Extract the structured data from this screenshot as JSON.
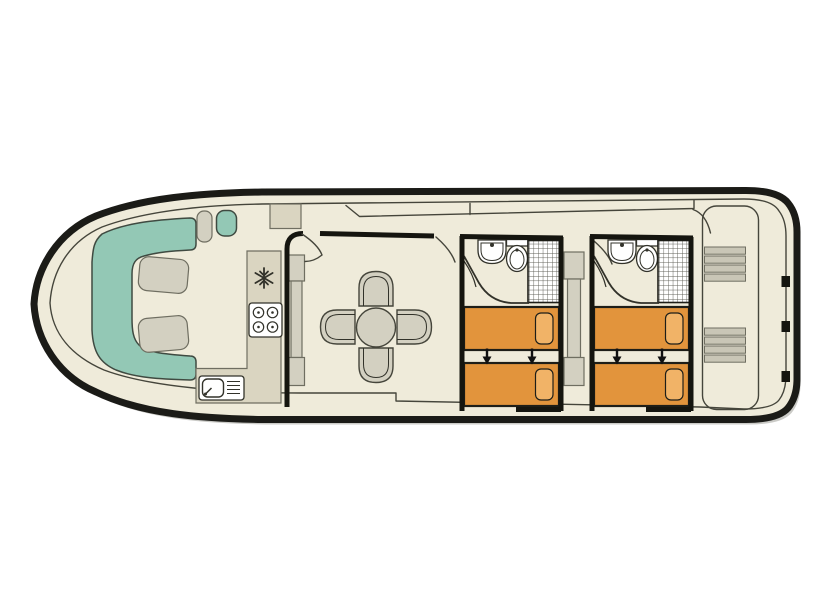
{
  "image": {
    "kind": "boat-deck-floor-plan",
    "label": "Canal boat deck plan, bow at left, stern at right"
  },
  "colors": {
    "page_bg": "#ffffff",
    "hull": "#1b1b17",
    "deck": "#EFEBDA",
    "line": "#45453b",
    "wall": "#15150f",
    "teal": "#93C8B5",
    "teal_line": "#3f4a41",
    "gray_furniture": "#D3D0C1",
    "gray_line": "#6f6e61",
    "counter": "#DAD5C1",
    "white": "#ffffff",
    "fixture_line": "#32322a",
    "bed": "#E2943C",
    "pillow": "#F1B367",
    "bed_line": "#1e1e18",
    "stair": "#C9C6B6",
    "arrow": "#111111",
    "shadow": "#cbcbc7",
    "shower_grid": "#5a5a52"
  },
  "features": {
    "bow_cockpit": {
      "items": [
        "u-shaped-bench-seat",
        "backrest-cushion",
        "backrest-cushion",
        "helm-seat",
        "side-seat",
        "console"
      ]
    },
    "galley": {
      "items": [
        "worktop",
        "fridge",
        "hob-4-burners",
        "sink-with-drainer"
      ]
    },
    "saloon": {
      "items": [
        "dining-table-round",
        "chair",
        "chair",
        "chair",
        "chair",
        "sideboard"
      ],
      "doors": 2
    },
    "cabins": [
      {
        "id": "cabin-1",
        "items": [
          "washbasin",
          "toilet",
          "shower",
          "single-bed",
          "single-bed",
          "slide-together-arrows"
        ]
      },
      {
        "id": "cabin-2",
        "items": [
          "washbasin",
          "toilet",
          "shower",
          "single-bed",
          "single-bed",
          "slide-together-arrows"
        ]
      }
    ],
    "wardrobe_between_cabins": true,
    "aft_deck": {
      "items": [
        "steps-forward",
        "steps-aft",
        "access-door"
      ]
    }
  }
}
